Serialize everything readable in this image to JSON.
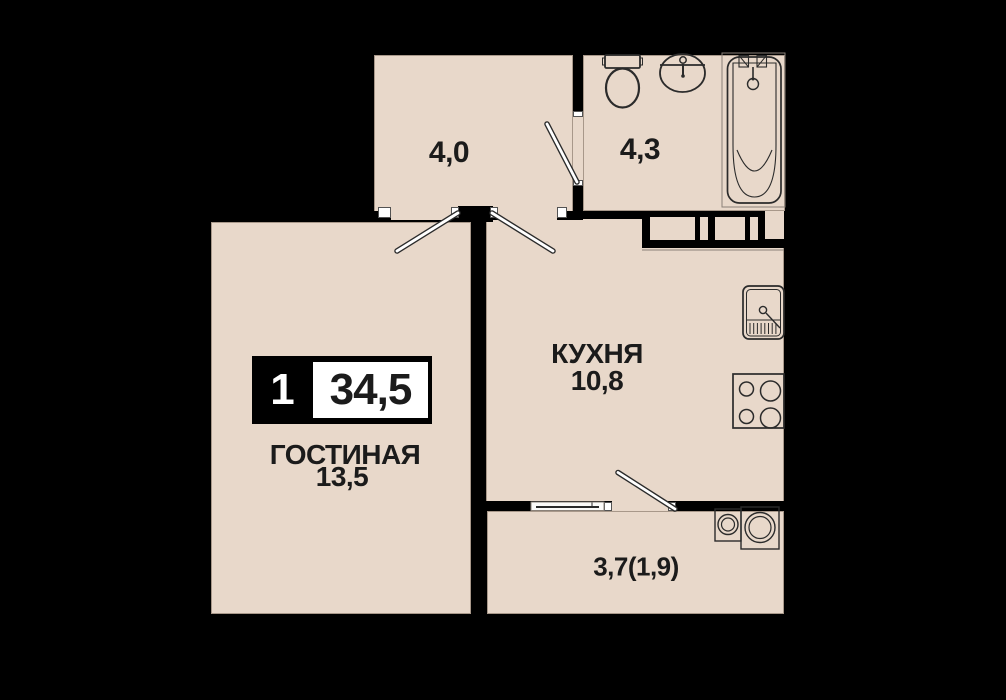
{
  "plan": {
    "type": "apartment-floor-plan",
    "badge": {
      "room_count": "1",
      "total_area": "34,5"
    },
    "rooms": [
      {
        "id": "hallway",
        "name": "",
        "area": "4,0"
      },
      {
        "id": "bathroom",
        "name": "",
        "area": "4,3"
      },
      {
        "id": "kitchen",
        "name": "КУХНЯ",
        "area": "10,8"
      },
      {
        "id": "living-room",
        "name": "ГОСТИНАЯ",
        "area": "13,5"
      },
      {
        "id": "balcony",
        "name": "",
        "area": "3,7(1,9)"
      }
    ],
    "colors": {
      "background": "#000000",
      "floor": "#e8d8ca",
      "wall": "#000000",
      "door_leaf": "#ffffff",
      "outline": "#2b2b2b",
      "soft_outline": "#8a8178",
      "text": "#1b1b1b",
      "badge_bg": "#000000",
      "badge_panel": "#ffffff"
    }
  }
}
